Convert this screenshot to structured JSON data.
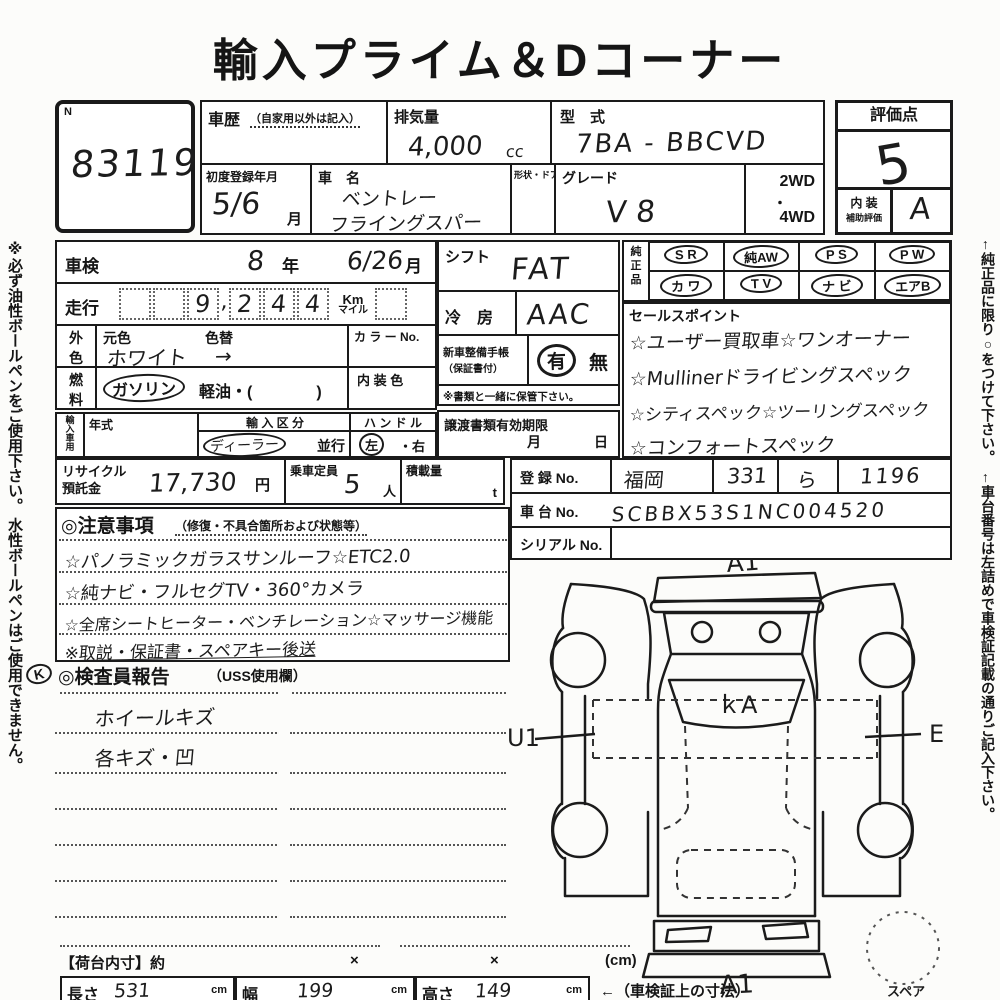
{
  "title": "輸入プライム＆Dコーナー",
  "margins": {
    "left_note": "※必ず油性ボールペンをご使用下さい。 水性ボールペンはご使用できません。",
    "right_note_1": "←純正品に限り○をつけて下さい。",
    "right_note_2": "←車台番号は左詰めで車検証記載の通りご記入下さい。"
  },
  "lot": {
    "n": "N",
    "number": "83119"
  },
  "header": {
    "history_label": "車歴",
    "history_note": "（自家用以外は記入）",
    "displacement_label": "排気量",
    "displacement_value": "4,000",
    "displacement_unit": "cc",
    "model_code_label": "型　式",
    "model_code_value": "7BA - BBCVD",
    "first_reg_label": "初度登録年月",
    "first_reg_value": "5/6",
    "first_reg_unit": "月",
    "car_name_label": "車　名",
    "car_name_line1": "ベントレー",
    "car_name_line2": "フライングスパー",
    "body_door_label": "形状・ドア数",
    "grade_label": "グレード",
    "grade_value": "V 8",
    "drive_1": "2WD",
    "drive_sep": "・",
    "drive_2": "4WD"
  },
  "score": {
    "label": "評価点",
    "value": "5",
    "interior_label_1": "内 装",
    "interior_label_2": "補助評価",
    "interior_value": "A"
  },
  "inspection": {
    "shaken_label": "車検",
    "shaken_year": "8",
    "year_unit": "年",
    "shaken_month": "6/26",
    "month_unit": "月",
    "mileage_label": "走行",
    "mileage_digits": [
      "9",
      "2",
      "4",
      "4"
    ],
    "mileage_comma": ",",
    "unit_km": "Km",
    "unit_mile": "マイル",
    "ext_color_label_1": "外",
    "ext_color_label_2": "色",
    "orig_color_label": "元色",
    "orig_color_value": "ホワイト",
    "color_change_label": "色替",
    "color_arrow": "→",
    "color_no_label": "カ ラ ー No.",
    "fuel_label_1": "燃",
    "fuel_label_2": "料",
    "fuel_gasoline": "ガソリン",
    "fuel_diesel": "軽油・(　　　　)",
    "interior_color_label": "内 装 色",
    "import_label": "輸入車用",
    "year_model_label": "年式",
    "import_class_label": "輸 入 区 分",
    "import_dealer": "ディーラー",
    "import_parallel": "並行",
    "handle_label": "ハ ン ド ル",
    "handle_left": "左",
    "handle_sep": "・",
    "handle_right": "右"
  },
  "equipment": {
    "shift_label": "シフト",
    "shift_value": "FAT",
    "ac_label": "冷　房",
    "ac_value": "AAC",
    "service_book_label_1": "新車整備手帳",
    "service_book_label_2": "（保証書付）",
    "service_book_yes": "有",
    "service_book_no": "無",
    "service_book_note": "※書類と一緒に保管下さい。",
    "transfer_label": "譲渡書類有効期限",
    "transfer_month": "月",
    "transfer_day": "日"
  },
  "genuine": {
    "label_1": "純",
    "label_2": "正",
    "label_3": "品",
    "row1": [
      "S R",
      "純AW",
      "P S",
      "P W"
    ],
    "row2": [
      "カ ワ",
      "T V",
      "ナ ビ",
      "エアB"
    ]
  },
  "sales_points": {
    "label": "セールスポイント",
    "lines": [
      "☆ユーザー買取車☆ワンオーナー",
      "☆Mullinerドライビングスペック",
      "☆シティスペック☆ツーリングスペック",
      "☆コンフォートスペック"
    ]
  },
  "recycle": {
    "label_1": "リサイクル",
    "label_2": "預託金",
    "value": "17,730",
    "unit": "円",
    "capacity_label": "乗車定員",
    "capacity_value": "5",
    "capacity_unit": "人",
    "load_label": "積載量",
    "load_unit": "t"
  },
  "registration": {
    "reg_label": "登 録 No.",
    "reg_area": "福岡",
    "reg_class": "331",
    "reg_kana": "ら",
    "reg_number": "1196",
    "chassis_label": "車 台 No.",
    "chassis_value": "SCBBX53S1NC004520",
    "serial_label": "シリアル No."
  },
  "notes": {
    "heading": "◎注意事項",
    "heading_note": "（修復・不具合箇所および状態等）",
    "lines": [
      "☆パノラミックガラスサンルーフ☆ETC2.0",
      "☆純ナビ・フルセグTV・360°カメラ",
      "☆全席シートヒーター・ベンチレーション☆マッサージ機能",
      "※取説・保証書・スペアキー後送"
    ]
  },
  "inspector_report": {
    "k_mark": "K",
    "heading": "◎検査員報告",
    "heading_note": "（USS使用欄）",
    "lines": [
      "ホイールキズ",
      "各キズ・凹"
    ]
  },
  "diagram": {
    "label_top": "A1",
    "label_windshield": "ｋA",
    "label_left": "U1",
    "label_right": "E",
    "label_bottom": "A1",
    "spare_label": "スペア"
  },
  "cargo": {
    "label": "【荷台内寸】約",
    "x1": "×",
    "x2": "×",
    "unit": "(cm)"
  },
  "dimensions": {
    "length_label": "長さ",
    "length_value": "531",
    "width_label": "幅",
    "width_value": "199",
    "height_label": "高さ",
    "height_value": "149",
    "cm": "cm",
    "note": "←（車検証上の寸法）"
  }
}
